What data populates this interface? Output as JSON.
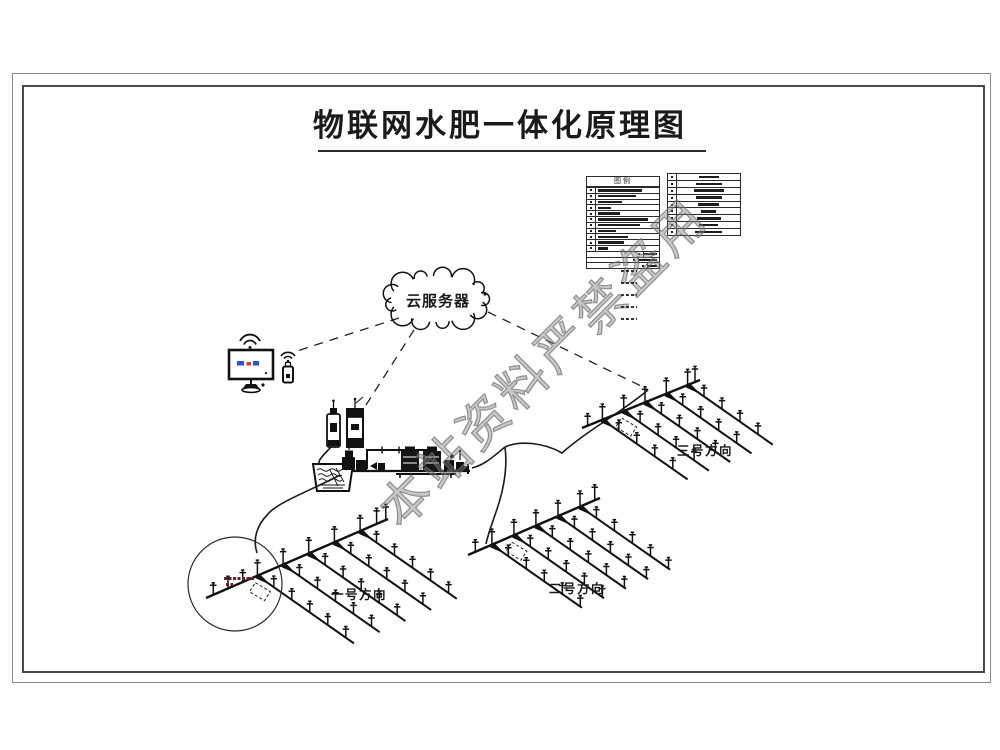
{
  "title": "物联网水肥一体化原理图",
  "watermark": "本站资料严禁盗用",
  "cloud": {
    "label": "云服务器"
  },
  "legend_left": {
    "header": "图例",
    "legibility": "illegible",
    "rows": [
      {
        "w": 44
      },
      {
        "w": 38
      },
      {
        "w": 24
      },
      {
        "w": 13
      },
      {
        "w": 22
      },
      {
        "w": 50
      },
      {
        "w": 42
      },
      {
        "w": 18
      },
      {
        "w": 30
      },
      {
        "w": 26
      },
      {
        "w": 10
      },
      {
        "w": 13,
        "align": "right"
      },
      {
        "w": 18,
        "align": "right"
      },
      {
        "w": 9,
        "align": "right"
      }
    ]
  },
  "legend_right": {
    "legibility": "illegible",
    "rows": [
      {
        "w": 20
      },
      {
        "w": 26
      },
      {
        "w": 30
      },
      {
        "w": 26
      },
      {
        "w": 21
      },
      {
        "w": 15
      },
      {
        "w": 24
      },
      {
        "w": 19
      },
      {
        "w": 27
      }
    ]
  },
  "legend_marks_count": 5,
  "fields": {
    "f1": {
      "label": "一号方向"
    },
    "f2": {
      "label": "二号方向"
    },
    "f3": {
      "label": "三号方向"
    }
  },
  "colors": {
    "line": "#111111",
    "frame": "#4a4a4a",
    "watermark_gray": "#7d7d7d",
    "screen_blue": "#2f55c4",
    "screen_red": "#cc4422"
  }
}
